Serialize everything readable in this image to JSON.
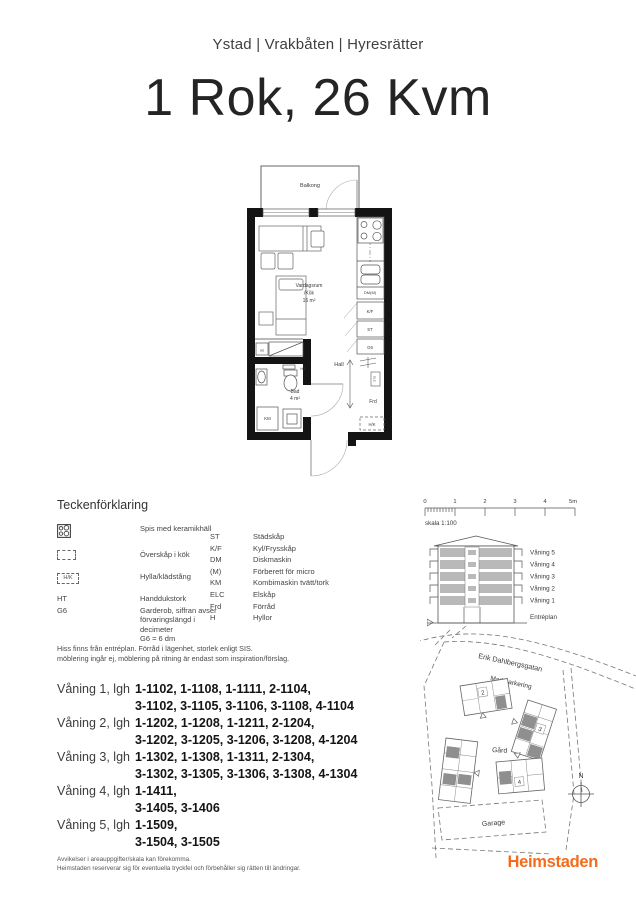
{
  "header": {
    "location": "Ystad | Vrakbåten | Hyresrätter",
    "title": "1 Rok, 26 Kvm"
  },
  "plan": {
    "labels": {
      "balkong": "Balkong",
      "vardagsrum": "Vardagsrum",
      "kok": "/Kök",
      "area": "16 m²",
      "hall": "Hall",
      "frd": "Frd",
      "bad": "Bad",
      "bad_area": "4 m²",
      "km": "KM",
      "ht": "HT",
      "h": "H",
      "dm": "DM(M)",
      "kf": "K/F",
      "st": "ST",
      "g6": "G6",
      "hk": "H/K",
      "elc": "ELC"
    }
  },
  "legend": {
    "title": "Teckenförklaring",
    "left": [
      {
        "icon": "stove-icon",
        "label": "Spis med keramikhäll"
      },
      {
        "icon": "overhead-cabinet-icon",
        "label": "Överskåp i kök"
      },
      {
        "icon": "shelf-rail-icon",
        "icon_text": "H/K",
        "label": "Hylla/klädstång"
      },
      {
        "abbr": "HT",
        "label": "Handdukstork"
      },
      {
        "abbr": "G6",
        "label": "Garderob, siffran avser\nförvaringslängd i decimeter\nG6 = 6 dm"
      }
    ],
    "right": [
      {
        "abbr": "ST",
        "label": "Städskåp"
      },
      {
        "abbr": "K/F",
        "label": "Kyl/Frysskåp"
      },
      {
        "abbr": "DM",
        "label": "Diskmaskin"
      },
      {
        "abbr": "(M)",
        "label": "Förberett för micro"
      },
      {
        "abbr": "KM",
        "label": "Kombimaskin tvätt/tork"
      },
      {
        "abbr": "ELC",
        "label": "Elskåp"
      },
      {
        "abbr": "Frd",
        "label": "Förråd"
      },
      {
        "abbr": "H",
        "label": "Hyllor"
      }
    ]
  },
  "notes": {
    "line1": "Hiss finns från entréplan. Förråd i lägenhet, storlek enligt SIS.",
    "line2": "möblering ingår ej, möblering på ritning är endast som inspiration/förslag."
  },
  "apartments": {
    "floors": [
      {
        "label": "Våning 1, lgh",
        "line1": "1-1102, 1-1108, 1-1111, 2-1104,",
        "line2": "3-1102, 3-1105, 3-1106, 3-1108, 4-1104"
      },
      {
        "label": "Våning 2, lgh",
        "line1": "1-1202, 1-1208, 1-1211, 2-1204,",
        "line2": "3-1202, 3-1205, 3-1206, 3-1208, 4-1204"
      },
      {
        "label": "Våning 3, lgh",
        "line1": "1-1302, 1-1308, 1-1311, 2-1304,",
        "line2": "3-1302, 3-1305, 3-1306, 3-1308, 4-1304"
      },
      {
        "label": "Våning 4, lgh",
        "line1": "1-1411,",
        "line2": "3-1405, 3-1406"
      },
      {
        "label": "Våning 5, lgh",
        "line1": "1-1509,",
        "line2": "3-1504, 3-1505"
      }
    ]
  },
  "scalebar": {
    "ticks": [
      "0",
      "1",
      "2",
      "3",
      "4",
      "5m"
    ],
    "caption": "skala 1:100"
  },
  "elevation": {
    "floors": [
      "Våning 5",
      "Våning 4",
      "Våning 3",
      "Våning 2",
      "Våning 1",
      "Entréplan"
    ]
  },
  "sitemap": {
    "street": "Erik Dahlbergsgatan",
    "parking": "Markparkering",
    "yard": "Gård",
    "garage": "Garage",
    "compass": "N",
    "buildings": {
      "b2": "2",
      "b3": "3",
      "b4": "4"
    }
  },
  "footer": {
    "disclaimer1": "Avvikelser i areauppgifter/skala kan förekomma.",
    "disclaimer2": "Heimstaden reserverar sig för eventuella tryckfel och förbehåller sig rätten till ändringar.",
    "logo": "Heimstaden"
  },
  "colors": {
    "brand_orange": "#F26C1B",
    "wall_black": "#141414",
    "site_grey": "#8f8f8f",
    "elevation_grey": "#b9b9b9"
  }
}
